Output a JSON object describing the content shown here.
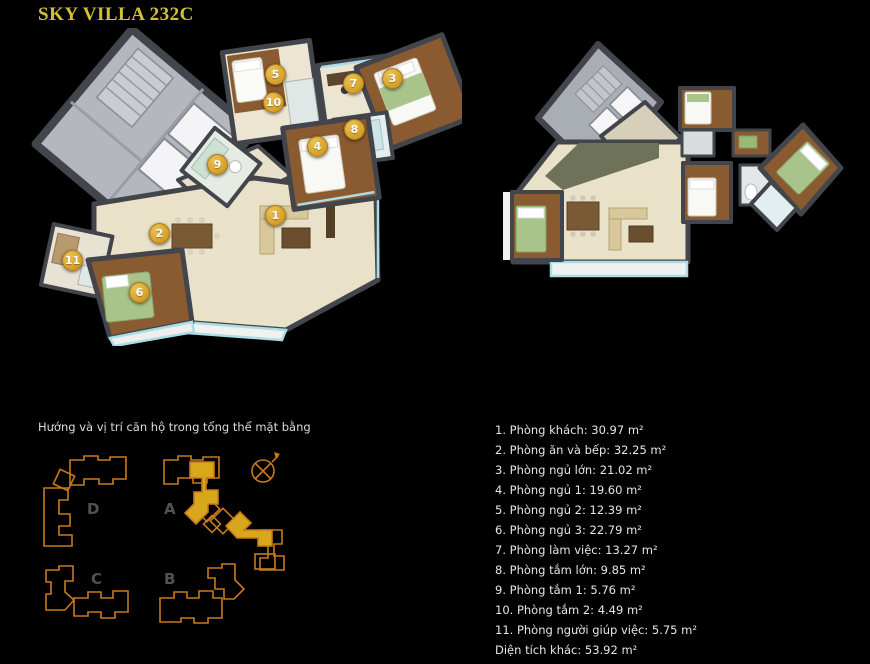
{
  "page": {
    "title": "SKY VILLA 232C",
    "background_color": "#000000",
    "title_color": "#d2c133"
  },
  "floorplan_3d": {
    "marker_color": "#d9a42c",
    "markers": [
      {
        "n": "1",
        "x": 245,
        "y": 187
      },
      {
        "n": "2",
        "x": 129,
        "y": 205
      },
      {
        "n": "3",
        "x": 362,
        "y": 50
      },
      {
        "n": "4",
        "x": 287,
        "y": 118
      },
      {
        "n": "5",
        "x": 245,
        "y": 46
      },
      {
        "n": "6",
        "x": 109,
        "y": 264
      },
      {
        "n": "7",
        "x": 323,
        "y": 55
      },
      {
        "n": "8",
        "x": 324,
        "y": 101
      },
      {
        "n": "9",
        "x": 187,
        "y": 136
      },
      {
        "n": "10",
        "x": 243,
        "y": 74
      },
      {
        "n": "11",
        "x": 42,
        "y": 232
      }
    ]
  },
  "siteplan": {
    "caption": "Hướng và vị trí căn hộ trong tổng thể mặt bằng",
    "outline_color": "#c87a1e",
    "highlight_color": "#d8a81c",
    "compass_icon": "compass-north-east",
    "blocks": [
      {
        "label": "D"
      },
      {
        "label": "A"
      },
      {
        "label": "C"
      },
      {
        "label": "B"
      }
    ]
  },
  "room_list": {
    "unit": "m²",
    "items": [
      {
        "no": "1",
        "label": "Phòng khách",
        "area": "30.97"
      },
      {
        "no": "2",
        "label": "Phòng ăn và bếp",
        "area": "32.25"
      },
      {
        "no": "3",
        "label": "Phòng ngủ lớn",
        "area": "21.02"
      },
      {
        "no": "4",
        "label": "Phòng ngủ 1",
        "area": "19.60"
      },
      {
        "no": "5",
        "label": "Phòng ngủ 2",
        "area": "12.39"
      },
      {
        "no": "6",
        "label": "Phòng ngủ 3",
        "area": "22.79"
      },
      {
        "no": "7",
        "label": "Phòng làm việc",
        "area": "13.27"
      },
      {
        "no": "8",
        "label": "Phòng tắm lớn",
        "area": "9.85"
      },
      {
        "no": "9",
        "label": "Phòng tắm 1",
        "area": "5.76"
      },
      {
        "no": "10",
        "label": "Phòng tắm 2",
        "area": "4.49"
      },
      {
        "no": "11",
        "label": "Phòng người giúp việc",
        "area": "5.75"
      },
      {
        "no": "",
        "label": "Diện tích khác",
        "area": "53.92"
      }
    ]
  }
}
